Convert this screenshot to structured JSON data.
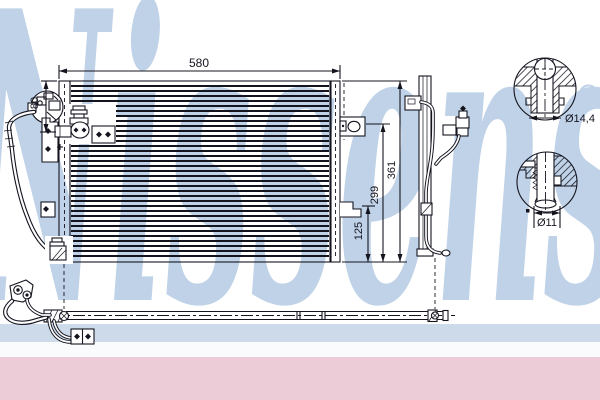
{
  "watermark": {
    "brand": "Nissens",
    "registered": "®"
  },
  "dimensions": {
    "top_width": "580",
    "left_height": "80",
    "right_total_height": "361",
    "right_mid_height": "299",
    "right_lower_height": "125"
  },
  "details": {
    "port_a_diameter": "Ø14,4",
    "port_b_diameter": "Ø11"
  },
  "colors": {
    "line": "#14141f",
    "watermark": "#bfd2e7",
    "band_blue": "#ccdaea",
    "band_white": "#fafbfc",
    "band_pink": "#ecccd7"
  }
}
